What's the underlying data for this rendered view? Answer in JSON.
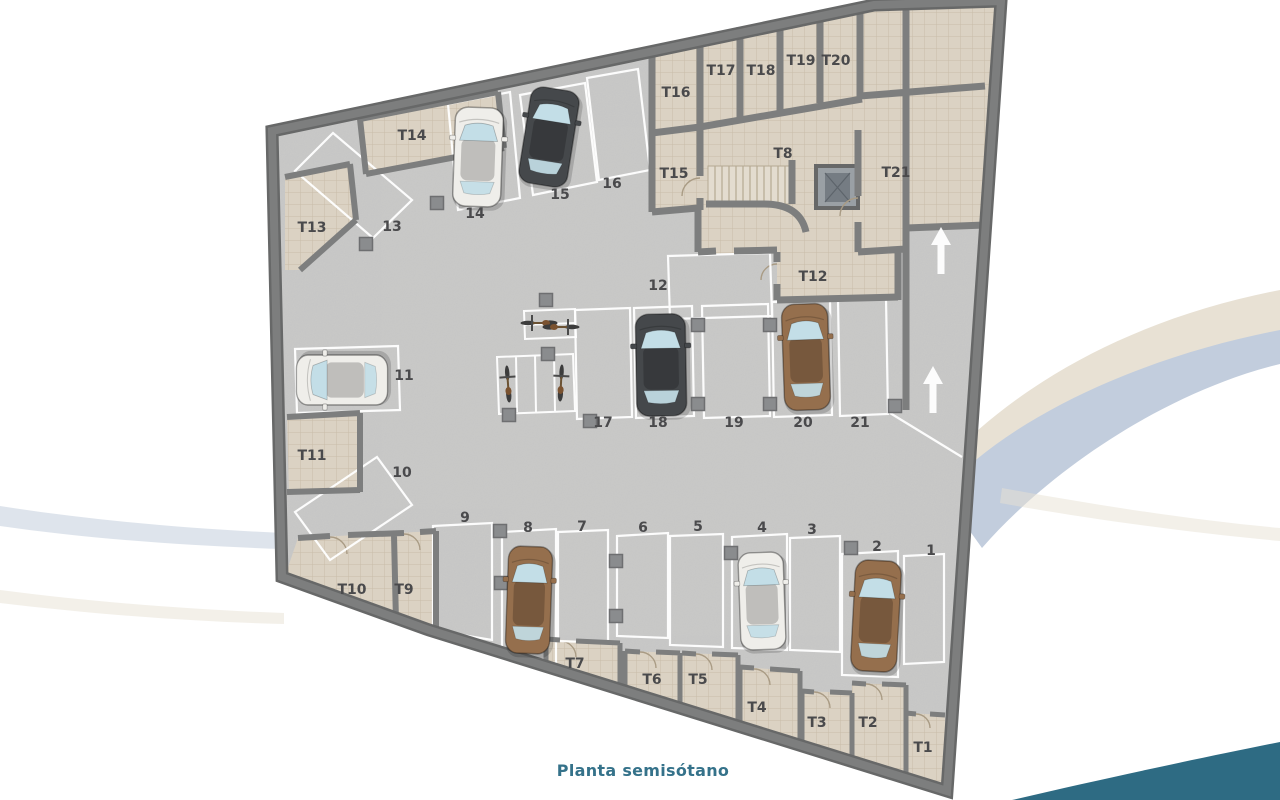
{
  "title": "Planta semisótano",
  "colors": {
    "wall": "#7d7e7e",
    "wall_dark": "#676868",
    "floor_garage": "#c8c8c7",
    "floor_storage": "#dbd2c3",
    "tile_line": "#c8bca8",
    "spot_outline": "#ffffff",
    "label": "#4a4a4c",
    "title": "#35728a",
    "swoosh_beige": "#e8e1d4",
    "swoosh_blue": "#c2cddd",
    "swoosh_teal": "#2e6b83",
    "car_white": "#efeeea",
    "car_dark": "#45484b",
    "car_brown": "#956f4d",
    "glass": "#c3dee7",
    "pillar": "#8a8c8e",
    "door_arc": "#a99b84",
    "stair_tread": "#b5a993"
  },
  "plan": {
    "labels": [
      {
        "t": "T1",
        "x": 923,
        "y": 752
      },
      {
        "t": "T2",
        "x": 868,
        "y": 727
      },
      {
        "t": "T3",
        "x": 817,
        "y": 727
      },
      {
        "t": "T4",
        "x": 757,
        "y": 712
      },
      {
        "t": "T5",
        "x": 698,
        "y": 684
      },
      {
        "t": "T6",
        "x": 652,
        "y": 684
      },
      {
        "t": "T7",
        "x": 575,
        "y": 668
      },
      {
        "t": "T8",
        "x": 783,
        "y": 158
      },
      {
        "t": "T9",
        "x": 404,
        "y": 594
      },
      {
        "t": "T10",
        "x": 352,
        "y": 594
      },
      {
        "t": "T11",
        "x": 312,
        "y": 460
      },
      {
        "t": "T12",
        "x": 813,
        "y": 281
      },
      {
        "t": "T13",
        "x": 312,
        "y": 232
      },
      {
        "t": "T14",
        "x": 412,
        "y": 140
      },
      {
        "t": "T15",
        "x": 674,
        "y": 178
      },
      {
        "t": "T16",
        "x": 676,
        "y": 97
      },
      {
        "t": "T17",
        "x": 721,
        "y": 75
      },
      {
        "t": "T18",
        "x": 761,
        "y": 75
      },
      {
        "t": "T19",
        "x": 801,
        "y": 65
      },
      {
        "t": "T20",
        "x": 836,
        "y": 65
      },
      {
        "t": "T21",
        "x": 896,
        "y": 177
      },
      {
        "t": "1",
        "x": 931,
        "y": 555
      },
      {
        "t": "2",
        "x": 877,
        "y": 551
      },
      {
        "t": "3",
        "x": 812,
        "y": 534
      },
      {
        "t": "4",
        "x": 762,
        "y": 532
      },
      {
        "t": "5",
        "x": 698,
        "y": 531
      },
      {
        "t": "6",
        "x": 643,
        "y": 532
      },
      {
        "t": "7",
        "x": 582,
        "y": 531
      },
      {
        "t": "8",
        "x": 528,
        "y": 532
      },
      {
        "t": "9",
        "x": 465,
        "y": 522
      },
      {
        "t": "10",
        "x": 402,
        "y": 477
      },
      {
        "t": "11",
        "x": 404,
        "y": 380
      },
      {
        "t": "12",
        "x": 658,
        "y": 290
      },
      {
        "t": "13",
        "x": 392,
        "y": 231
      },
      {
        "t": "14",
        "x": 475,
        "y": 218
      },
      {
        "t": "15",
        "x": 560,
        "y": 199
      },
      {
        "t": "16",
        "x": 612,
        "y": 188
      },
      {
        "t": "17",
        "x": 603,
        "y": 427
      },
      {
        "t": "18",
        "x": 658,
        "y": 427
      },
      {
        "t": "19",
        "x": 734,
        "y": 427
      },
      {
        "t": "20",
        "x": 803,
        "y": 427
      },
      {
        "t": "21",
        "x": 860,
        "y": 427
      }
    ],
    "cars": [
      {
        "spot": "14",
        "color": "white",
        "x": 478,
        "y": 157,
        "rot": 2,
        "w": 50,
        "l": 100
      },
      {
        "spot": "15",
        "color": "dark",
        "x": 549,
        "y": 137,
        "rot": 9,
        "w": 51,
        "l": 98
      },
      {
        "spot": "11",
        "color": "white",
        "x": 342,
        "y": 380,
        "rot": -90,
        "w": 52,
        "l": 92
      },
      {
        "spot": "18",
        "color": "dark",
        "x": 661,
        "y": 365,
        "rot": -1,
        "w": 52,
        "l": 103
      },
      {
        "spot": "20",
        "color": "brown",
        "x": 806,
        "y": 357,
        "rot": -2,
        "w": 48,
        "l": 107
      },
      {
        "spot": "8",
        "color": "brown",
        "x": 529,
        "y": 600,
        "rot": 2,
        "w": 46,
        "l": 108
      },
      {
        "spot": "4",
        "color": "white",
        "x": 762,
        "y": 601,
        "rot": -2,
        "w": 47,
        "l": 98
      },
      {
        "spot": "2",
        "color": "brown",
        "x": 876,
        "y": 616,
        "rot": 3,
        "w": 48,
        "l": 112
      }
    ],
    "bikes": [
      {
        "x": 539,
        "y": 323,
        "rot": -90
      },
      {
        "x": 561,
        "y": 327,
        "rot": 90
      },
      {
        "x": 508,
        "y": 384,
        "rot": -4
      },
      {
        "x": 561,
        "y": 383,
        "rot": 3
      }
    ],
    "ramp_arrows": [
      {
        "x": 941,
        "y": 251
      },
      {
        "x": 933,
        "y": 390
      }
    ],
    "pillars": [
      {
        "x": 437,
        "y": 203
      },
      {
        "x": 366,
        "y": 244
      },
      {
        "x": 546,
        "y": 300
      },
      {
        "x": 548,
        "y": 354
      },
      {
        "x": 509,
        "y": 415
      },
      {
        "x": 590,
        "y": 421
      },
      {
        "x": 698,
        "y": 325
      },
      {
        "x": 698,
        "y": 404
      },
      {
        "x": 770,
        "y": 325
      },
      {
        "x": 770,
        "y": 404
      },
      {
        "x": 500,
        "y": 531
      },
      {
        "x": 501,
        "y": 583
      },
      {
        "x": 616,
        "y": 561
      },
      {
        "x": 616,
        "y": 616
      },
      {
        "x": 731,
        "y": 553
      },
      {
        "x": 851,
        "y": 548
      },
      {
        "x": 895,
        "y": 406
      }
    ]
  }
}
